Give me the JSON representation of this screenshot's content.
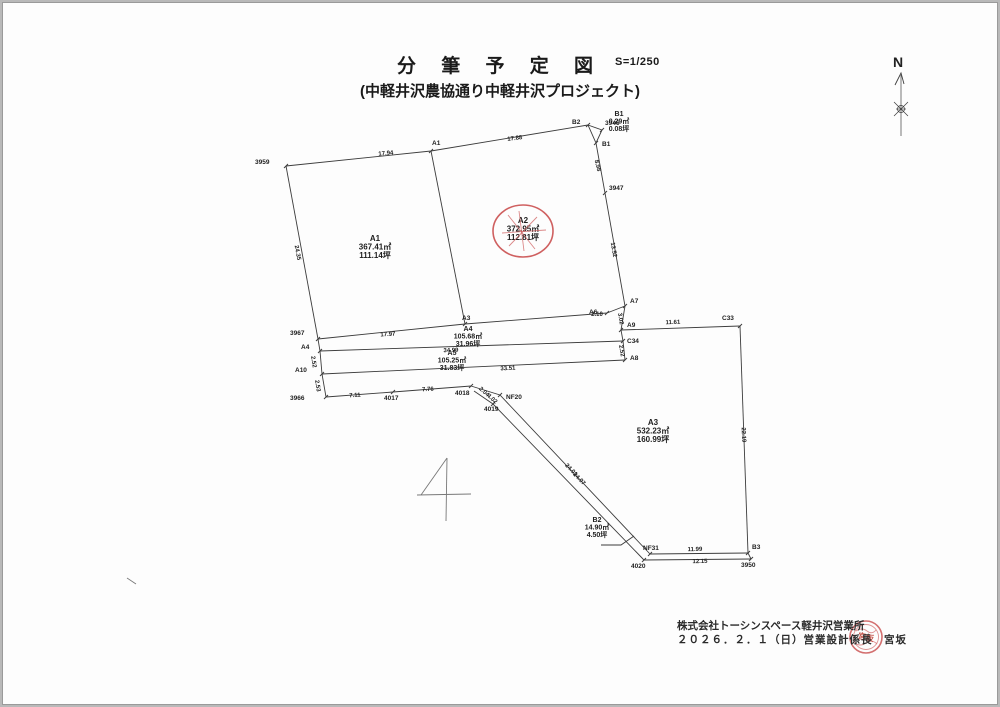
{
  "page": {
    "title": "分 筆 予 定 図",
    "scale": "S=1/250",
    "subtitle": "(中軽井沢農協通り中軽井沢プロジェクト)",
    "north_label": "N",
    "footer": {
      "company": "株式会社トーシンスペース軽井沢営業所",
      "date_line": "２０２６．２．１（日）営業設計係長　宮坂",
      "stamp_text": "宮坂"
    },
    "colors": {
      "line": "#3c3c3c",
      "annotation_red": "#cf6060",
      "stamp_red": "#c0453a",
      "paper": "#fdfdfd"
    }
  },
  "drawing": {
    "parcels": [
      {
        "id": "A1",
        "m2": "367.41㎡",
        "tsubo": "111.14坪",
        "x": 372,
        "y": 238,
        "fs": 8,
        "circled": false
      },
      {
        "id": "A2",
        "m2": "372.95㎡",
        "tsubo": "112.81坪",
        "x": 520,
        "y": 220,
        "fs": 8,
        "circled": true
      },
      {
        "id": "A3",
        "m2": "532.23㎡",
        "tsubo": "160.99坪",
        "x": 650,
        "y": 422,
        "fs": 8,
        "circled": false
      },
      {
        "id": "A4",
        "m2": "105.68㎡",
        "tsubo": "31.96坪",
        "x": 465,
        "y": 328,
        "fs": 7,
        "circled": false
      },
      {
        "id": "A5",
        "m2": "105.25㎡",
        "tsubo": "31.83坪",
        "x": 449,
        "y": 352,
        "fs": 7,
        "circled": false
      },
      {
        "id": "B1",
        "m2": "0.29㎡",
        "tsubo": "0.08坪",
        "x": 616,
        "y": 113,
        "fs": 7,
        "circled": false
      },
      {
        "id": "B2",
        "m2": "14.90㎡",
        "tsubo": "4.50坪",
        "x": 594,
        "y": 519,
        "fs": 7,
        "circled": false
      }
    ],
    "points": [
      {
        "label": "3959",
        "x": 283,
        "y": 163,
        "lx": 252,
        "ly": 161
      },
      {
        "label": "A1",
        "x": 428,
        "y": 148,
        "lx": 429,
        "ly": 142
      },
      {
        "label": "B2",
        "x": 585,
        "y": 122,
        "lx": 569,
        "ly": 121
      },
      {
        "label": "3946",
        "x": 599,
        "y": 127,
        "lx": 602,
        "ly": 122
      },
      {
        "label": "B1",
        "x": 593,
        "y": 140,
        "lx": 599,
        "ly": 143
      },
      {
        "label": "3947",
        "x": 602,
        "y": 190,
        "lx": 606,
        "ly": 187
      },
      {
        "label": "A7",
        "x": 622,
        "y": 303,
        "lx": 627,
        "ly": 300
      },
      {
        "label": "A6",
        "x": 604,
        "y": 310,
        "lx": 586,
        "ly": 311
      },
      {
        "label": "A9",
        "x": 618,
        "y": 327,
        "lx": 624,
        "ly": 324
      },
      {
        "label": "C34",
        "x": 620,
        "y": 338,
        "lx": 624,
        "ly": 340
      },
      {
        "label": "A8",
        "x": 622,
        "y": 357,
        "lx": 627,
        "ly": 357
      },
      {
        "label": "C33",
        "x": 737,
        "y": 323,
        "lx": 719,
        "ly": 317
      },
      {
        "label": "3967",
        "x": 315,
        "y": 336,
        "lx": 287,
        "ly": 332
      },
      {
        "label": "A4",
        "x": 317,
        "y": 348,
        "lx": 298,
        "ly": 346
      },
      {
        "label": "A10",
        "x": 319,
        "y": 371,
        "lx": 292,
        "ly": 369
      },
      {
        "label": "3966",
        "x": 323,
        "y": 394,
        "lx": 287,
        "ly": 397
      },
      {
        "label": "4017",
        "x": 390,
        "y": 389,
        "lx": 381,
        "ly": 397
      },
      {
        "label": "4018",
        "x": 468,
        "y": 383,
        "lx": 452,
        "ly": 392
      },
      {
        "label": "NF20",
        "x": 497,
        "y": 392,
        "lx": 503,
        "ly": 396
      },
      {
        "label": "4019",
        "x": 490,
        "y": 401,
        "lx": 481,
        "ly": 408
      },
      {
        "label": "NF31",
        "x": 647,
        "y": 551,
        "lx": 640,
        "ly": 547
      },
      {
        "label": "4020",
        "x": 641,
        "y": 557,
        "lx": 628,
        "ly": 565
      },
      {
        "label": "B3",
        "x": 745,
        "y": 550,
        "lx": 749,
        "ly": 546
      },
      {
        "label": "3950",
        "x": 748,
        "y": 556,
        "lx": 738,
        "ly": 564
      },
      {
        "label": "A3",
        "x": 462,
        "y": 321,
        "lx": 459,
        "ly": 317
      }
    ],
    "dims": [
      {
        "t": "17.94",
        "x": 383,
        "y": 152,
        "r": -5
      },
      {
        "t": "17.88",
        "x": 512,
        "y": 137,
        "r": -7
      },
      {
        "t": "8.98",
        "x": 593,
        "y": 163,
        "r": 76
      },
      {
        "t": "13.52",
        "x": 609,
        "y": 247,
        "r": 80
      },
      {
        "t": "2.10",
        "x": 594,
        "y": 313,
        "r": 0
      },
      {
        "t": "3.02",
        "x": 616,
        "y": 316,
        "r": 80
      },
      {
        "t": "2.52",
        "x": 617,
        "y": 348,
        "r": 80
      },
      {
        "t": "11.61",
        "x": 670,
        "y": 321,
        "r": -2
      },
      {
        "t": "22.19",
        "x": 739,
        "y": 432,
        "r": 87
      },
      {
        "t": "11.99",
        "x": 692,
        "y": 548,
        "r": -1
      },
      {
        "t": "12.15",
        "x": 697,
        "y": 560,
        "r": -1
      },
      {
        "t": "24.01",
        "x": 567,
        "y": 468,
        "r": 46
      },
      {
        "t": "24.07",
        "x": 575,
        "y": 477,
        "r": 46
      },
      {
        "t": "17.97",
        "x": 385,
        "y": 333,
        "r": -4
      },
      {
        "t": "34.99",
        "x": 448,
        "y": 349,
        "r": -2
      },
      {
        "t": "33.51",
        "x": 505,
        "y": 367,
        "r": -3
      },
      {
        "t": "7.11",
        "x": 352,
        "y": 394,
        "r": -4
      },
      {
        "t": "7.76",
        "x": 425,
        "y": 388,
        "r": -4
      },
      {
        "t": "2.04",
        "x": 480,
        "y": 390,
        "r": 42
      },
      {
        "t": "4.02",
        "x": 488,
        "y": 397,
        "r": 42
      },
      {
        "t": "24.35",
        "x": 293,
        "y": 250,
        "r": 79
      },
      {
        "t": "2.52",
        "x": 309,
        "y": 359,
        "r": 82
      },
      {
        "t": "2.53",
        "x": 313,
        "y": 383,
        "r": 82
      }
    ],
    "segments": [
      {
        "pts": [
          [
            283,
            163
          ],
          [
            428,
            148
          ],
          [
            585,
            122
          ]
        ]
      },
      {
        "pts": [
          [
            585,
            122
          ],
          [
            599,
            127
          ],
          [
            593,
            140
          ],
          [
            585,
            122
          ]
        ]
      },
      {
        "pts": [
          [
            593,
            140
          ],
          [
            602,
            190
          ],
          [
            622,
            303
          ]
        ]
      },
      {
        "pts": [
          [
            283,
            163
          ],
          [
            315,
            336
          ]
        ]
      },
      {
        "pts": [
          [
            428,
            148
          ],
          [
            462,
            321
          ]
        ]
      },
      {
        "pts": [
          [
            315,
            336
          ],
          [
            462,
            321
          ],
          [
            604,
            310
          ]
        ]
      },
      {
        "pts": [
          [
            604,
            310
          ],
          [
            622,
            303
          ]
        ]
      },
      {
        "pts": [
          [
            315,
            336
          ],
          [
            317,
            348
          ],
          [
            319,
            371
          ],
          [
            323,
            394
          ]
        ]
      },
      {
        "pts": [
          [
            317,
            348
          ],
          [
            620,
            338
          ]
        ]
      },
      {
        "pts": [
          [
            319,
            371
          ],
          [
            622,
            357
          ]
        ]
      },
      {
        "pts": [
          [
            622,
            303
          ],
          [
            618,
            327
          ],
          [
            620,
            338
          ],
          [
            622,
            357
          ]
        ]
      },
      {
        "pts": [
          [
            618,
            327
          ],
          [
            737,
            323
          ]
        ]
      },
      {
        "pts": [
          [
            737,
            323
          ],
          [
            745,
            550
          ]
        ]
      },
      {
        "pts": [
          [
            647,
            551
          ],
          [
            745,
            550
          ]
        ]
      },
      {
        "pts": [
          [
            641,
            557
          ],
          [
            748,
            556
          ]
        ]
      },
      {
        "pts": [
          [
            745,
            550
          ],
          [
            748,
            556
          ]
        ]
      },
      {
        "pts": [
          [
            323,
            394
          ],
          [
            390,
            389
          ],
          [
            468,
            383
          ]
        ]
      },
      {
        "pts": [
          [
            468,
            383
          ],
          [
            497,
            392
          ],
          [
            647,
            551
          ]
        ]
      },
      {
        "pts": [
          [
            471,
            388
          ],
          [
            490,
            401
          ],
          [
            641,
            557
          ]
        ]
      },
      {
        "pts": [
          [
            598,
            542
          ],
          [
            618,
            542
          ],
          [
            631,
            533
          ]
        ]
      }
    ],
    "pencil": [
      {
        "pts": [
          [
            444,
            455
          ],
          [
            418,
            492
          ]
        ]
      },
      {
        "pts": [
          [
            414,
            492
          ],
          [
            468,
            491
          ]
        ]
      },
      {
        "pts": [
          [
            444,
            455
          ],
          [
            443,
            518
          ]
        ]
      },
      {
        "pts": [
          [
            124,
            575
          ],
          [
            133,
            581
          ]
        ]
      }
    ],
    "red_circle": {
      "cx": 520,
      "cy": 228,
      "rx": 30,
      "ry": 26
    },
    "red_strokes": [
      [
        [
          505,
          212
        ],
        [
          532,
          246
        ]
      ],
      [
        [
          534,
          214
        ],
        [
          506,
          243
        ]
      ],
      [
        [
          499,
          230
        ],
        [
          543,
          227
        ]
      ],
      [
        [
          516,
          208
        ],
        [
          521,
          248
        ]
      ]
    ]
  }
}
